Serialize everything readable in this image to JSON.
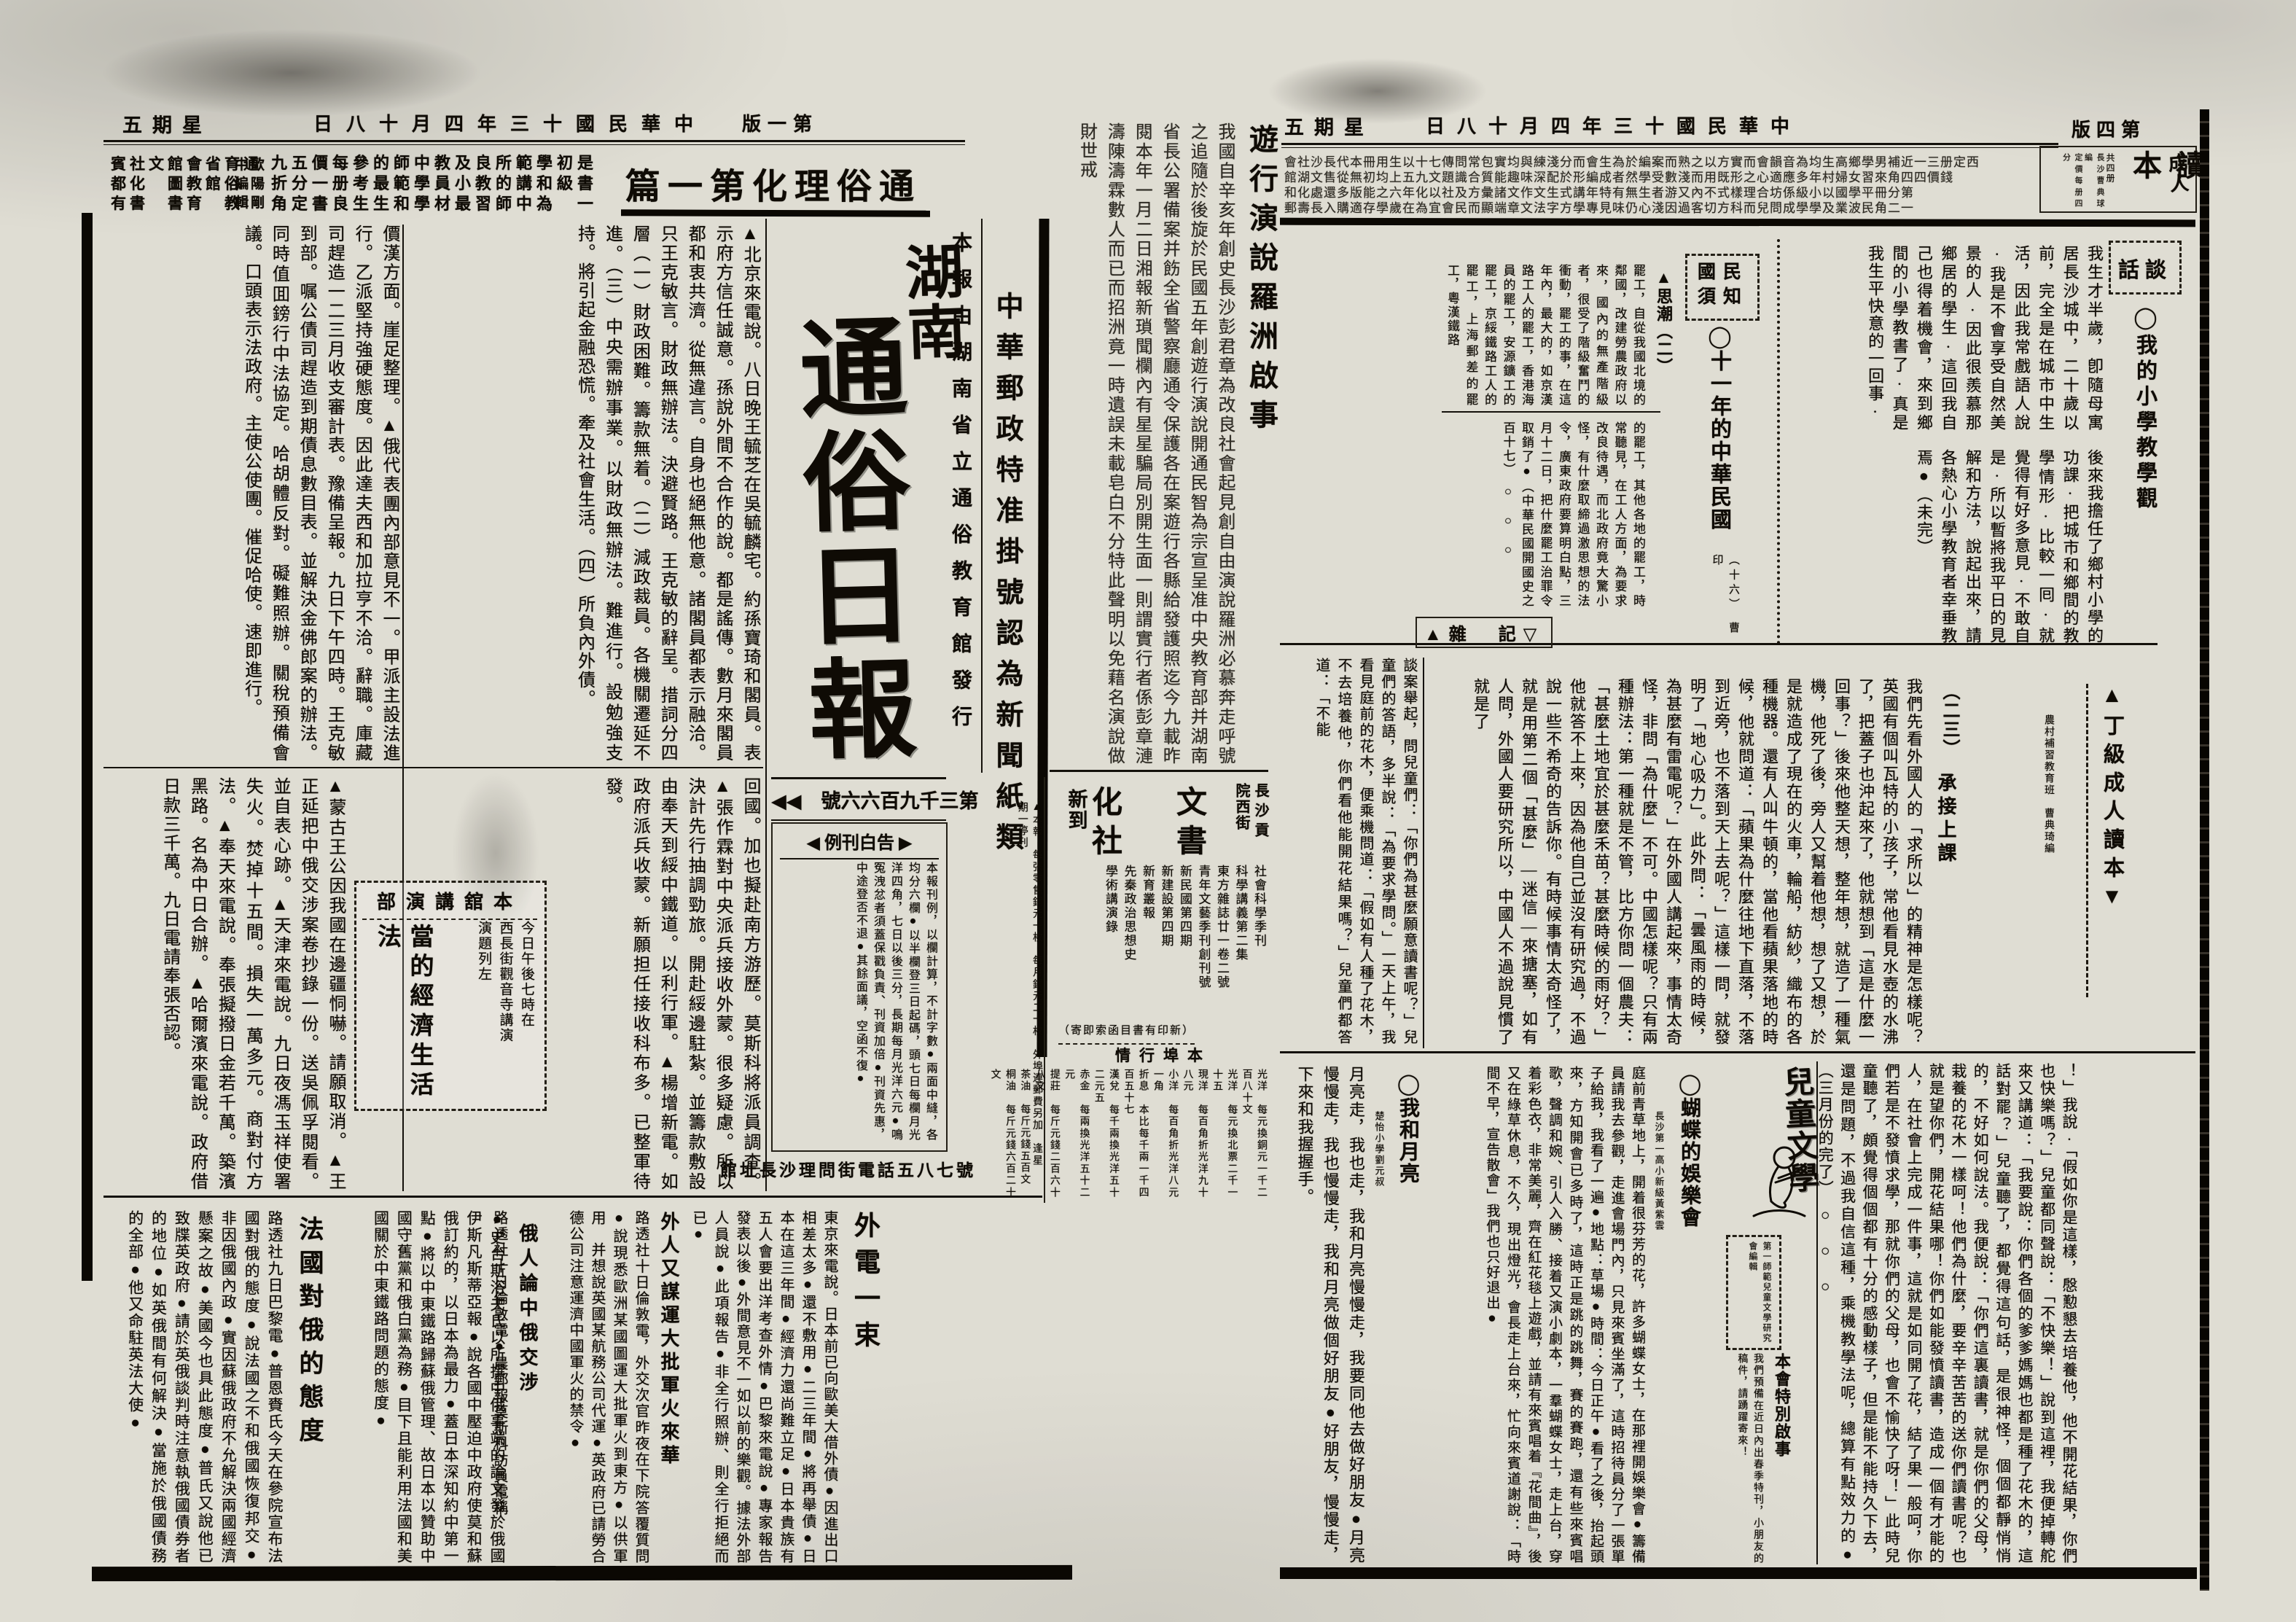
{
  "page1": {
    "header": {
      "weekday": "五期星",
      "date": "日八十月四年三十國民華中",
      "page": "版一第"
    },
    "top_ad": {
      "pub_rows": "賓社文館會省育通\n都化　圖教館俗\n有書　書育　教",
      "editor_rows": "中歐\n編陽\n輯剛",
      "rows": "九五價每參的師中教及良所範學初是\n折分一册考最範學員小教的講和級書\n角定書良生生和學材最習師中為　一",
      "headline": "篇一第化理俗通"
    },
    "announcement": {
      "title": "遊行演說羅洲啟事",
      "body": "我國自辛亥年創史長沙彭君章為改良社會起見創自由演說羅洲必慕奔走呼號之追隨於後旋於民國五年創遊行演說開通民智為宗宣呈准中央教育部并湖南省長公署備案并飭全省警察廳通令保護各在案遊行各縣給發護照迄今九載昨閱本年一月二日湘報新瑣聞欄內有星星騙局別開生面一則謂實行者係彭章漣濤陳濤霖數人而已而招洲竟一時遺誤未載皂白不分特此聲明以免藉名演說做財世戒"
    },
    "postal": "中華郵政特准掛號認為新聞紙類",
    "masthead": {
      "pub_line": "本報由湖南省立通俗教育館發行",
      "title_top": "湖南",
      "title_main": "通俗日報",
      "issue": "◀◀　號六六百九千三第"
    },
    "price_note": "▲本報　每張零售銅元一枚　每月銅元二十枚　外埠連郵費另加　逢星期一停刊",
    "adrates": {
      "title": "◀ 例刊白告 ▶",
      "body": "本報刊例，以欄計算，不計字數●兩面中縫，各均分六欄●以半欄登三日起碼，頭七日每欄月光洋四角，七日以後三分，長期每月光洋六元●鳴冤洩忿者須蓋保戳負責、刊資加倍●刊資先惠，中途登否不退●其餘面議，空函不復●"
    },
    "phone": "館址長沙理問街電話五八七號",
    "news": {
      "tr": "▲北京來電說。八日晚王毓芝在吳毓麟宅。約孫寶琦和閣員。表示府方信任誠意。孫說外間不合作的說。都是謠傳。數月來閣員都和衷共濟。從無違言。自身也絕無他意。諸閣員都表示融洽。只王克敏言。財政無辦法。決避賢路。王克敏的辭呈。措詞分四層（一）財政困難。籌款無着。（二）減政裁員。各機關遷延不進。（三）中央需辦事業。以財政無辦法。難進行。設勉強支持。將引起金融恐慌。牽及社會生活。（四）所負內外債。",
      "tl": "價漢方面。崖足整理。▲俄代表團內部意見不一。甲派主設法進行。乙派堅持強硬態度。因此達夫西和加拉亨不洽。辭職。庫藏司趕造一二三月收支審計表。豫備呈報。九日下午四時。王克敏到部。嘱公債司趕造到期債息數目表。並解決金佛郎案的辦法。同時值囬鎊行中法協定。哈胡體反對。礙難照辦。關稅預備會議。口頭表示法政府。主使公使團。催促哈使。速即進行。",
      "br": "回國。加也擬赴南方游歷。莫斯科將派員調查。▲張作霖對中央派兵接收外蒙。很多疑慮。所以決計先行抽調勁旅。開赴綏邊駐紮。並籌款敷設由奉天到綏中鐵道。以利行軍。▲楊增新電。如政府派兵收蒙。新願担任接收科布多。已整軍待發。",
      "bl": "▲蒙古王公因我國在邊疆恫嚇。請願取消。▲王正延把中俄交涉案卷抄錄一份。送吳佩孚閱看。並自表心跡。▲天津來電說。九日夜馮玉祥使署失火。焚掉十五間。損失一萬多元。商對付方法。▲奉天來電說。奉張擬撥日金若千萬。築濱黑路。名為中日合辦。▲哈爾濱來電說。政府借日款三千萬。九日電請奉張否認。"
    },
    "lecture_ad": {
      "title": "部演講舘本",
      "lines": "今日午後七時在\n西長街觀音寺講演\n演題列左",
      "big": "當的經濟生活法"
    },
    "bookstore": {
      "loc": "長沙貢院西街",
      "big_rows": "化　文\n社　書",
      "new_label": "新到",
      "books": "社會科學季刊\n科學講義第二集\n東方雜誌廿一卷二號\n青年文藝季刊創刊號\n新民國第四期\n新建設第四期\n新育叢報\n先秦政治思想史\n學術講演錄",
      "note": "（寄即索函目書有印新）",
      "market_title": "情行埠本",
      "market": "光洋　每元換銅元一千二百八十文\n光洋　每元換北票二千一十五\n現洋　每百角折光洋九十八元\n小洋　每百角折光洋八元一角\n折息　本比每千兩一千四百五十七\n漢兌　每千兩換光洋五十二元五\n赤金　每兩換光洋五十二元\n提莊　每斤元錢二百六十八文\n茶油　每斤元錢五百文\n桐油　每斤元錢六百二十文"
    },
    "bottom": {
      "france_title": "法國對俄的態度",
      "france_right": "●史台斯浴夫氏以所撰中俄事端的論文發於俄國伊斯凡斯蒂亞報●說各國中壓迫中政府使莫和蘇俄訂約的，以日本為最力●蓋日本深知約中第一點●將以中東鐵路歸蘇俄管理、故日本以贊助中國守舊黨和俄白黨為務●目下且能利用法國和美國關於中東鐵路問題的態度●",
      "france_left": "路透社九日巴黎電●普恩賚氏今天在參院宣布法國對俄的態度●說法國之不和俄國恢復邦交●非因俄國內政●實因蘇俄政府不允解決兩國經濟懸案之故●美國今也具此態度●普氏又說他已致牒英政府●請於英俄談判時注意執俄國債券者的地位●如英俄間有何解決●當施於俄國債務的全部●他又命駐英法大使●",
      "wire_title": "外電一束",
      "wire_body": "東京來電說。日本前已向歐美大借外債●因進出口相差太多●還不敷用●二三年間●將再舉債●日本在這三年間●經濟力還尚難立足●日本貴族有五人會要出洋考查外情●巴黎來電說●專家報告發表以後●外間意見不一如以前的樂觀。據法外部人員說●此項報告●非全行照辦、則全行拒絕而已●",
      "arms_title": "外人又謀運大批軍火來華",
      "arms_body": "路透社十日倫敦電，外交次官昨夜在下院答覆質問●說現悉歐洲某國圖運大批軍火到東方●以供軍用　并想說英國某航務公司代運●英政府已請勞合德公司注意運濟中國軍火的禁令●",
      "russia_title": "俄人論中俄交涉",
      "russia_body": "路透社十日倫敦電●晨郵報莫斯科訪員電稱"
    }
  },
  "page4": {
    "header": {
      "weekday": "五期星",
      "date": "日八十月四年三十國民華中",
      "page": "版四第"
    },
    "masthead": {
      "t1": "成人",
      "t2": "讀本",
      "n1": "共四册",
      "n2": "長沙曹典球編",
      "n3": "定價每册四分"
    },
    "ad_rows": "會社沙長代本冊用生以十七傳問常包實均與練淺分而會生為於編案而熟之以方實而會韻音為均生高鄉學男補近一三册定西\n館湖文售從無初均上五九文題識合質能趣味深配於形編成者然學受數淺而用既形之心適應多年村婦女習來角四四價錢\n和化處還多版能之六年化以社及方彙諸文作文生式講年特有無生者游又內不式樣理合坊係級小以國學平冊分第\n郵壽長入購適存學歲在為宜會民而顯端章文法字方學專見味仍心淺因過客切方科而兒問成學學及業波民角二一",
    "talk": {
      "box": "話談",
      "title": "◯我的小學教學觀",
      "upper": "我生才半歲，卽隨母寓居長沙城中，二十歲以前，完全是在城市中生活，因此我常戲語人說·我是不會享受自然美景的人·因此很羨慕那鄉居的學生·這回我自己也得着機會，來到鄉間的小學教書了·真是我生平快意的一回事·",
      "lower": "後來我擔任了鄉村小學的功課·把城市和鄉間的教學情形·比較一囘·就覺得有好多意見·不敢自是·所以暫將我平日的見解和方法，說起出來，請各熱心小學教育者幸垂教焉●（未完）"
    },
    "guomin": {
      "box": "國民\n須知",
      "title": "◯十一年的中華民國",
      "sub": "（十六）　曹印",
      "thought": "▲思潮（二）",
      "upper": "罷工，自從我國北境的鄰國，改建勞農政府以來，國內的無產階級者，很受了階級奮鬥的衝動，罷工的事，在這年內，最大的，如京漢路工人的罷工，香港海員的罷工，安源鑛工的罷工，京綏鐵路工人的罷工，上海郵差的罷工，粵漢鐵路",
      "lower": "的罷工，其他各地的罷工，時常聽見，在工人方面，為要求改良待遇，而北政府竟大驚小怪，有什麼取締過激思想的法令，廣東政府要算明白點，三月十二日，把什麼罷工治罪令取銷了●（中華民國開國史之百十七）　○　○　○"
    },
    "zaji": {
      "header": "▲雜　記▽",
      "body": "談案舉起，問兒童們：「你們為甚麼願意讀書呢？」兒童們的答語，多半說：「為要求學問。」一天上午，我看見庭前的花木，便乘機問道：「假如有人種了花木，不去培養他，你們看他能開花結果嗎？」兒童們都答道：「不能"
    },
    "lesson": {
      "grade": "▲丁級成人讀本▼",
      "byline": "農村補習教育班　曹典琦編",
      "no": "（二三）",
      "title": "承接上課",
      "body": "我們先看外國人的「求所以」的精神是怎樣呢？英國有個叫瓦特的小孩子，常他看見水壺的水沸了，把蓋子也沖起來了，他就想到「這是什麼一回事？」後來他整天想，整年想，就造了一種氣機，他死了後，旁人又幫着他想，想了又想，於是就造成了現在的火車，輪船，紡紗，織布的各種機器。還有人叫牛頓的，當他看蘋果落地的時候，他就問道：「蘋果為什麼往地下直落，不落到近旁，也不落到天上去呢？」這樣一問，就發明了「地心吸力」。此外問：「曇風雨的時候，為甚麼有雷電呢？」在外國人講起來，事情太奇怪，非問「為什麼」不可。中國怎樣呢？只有兩種辦法：第一種就是不管，比方你問一個農夫：「甚麼土地宜於甚麼禾苗？甚麼時候的雨好？」他就答不上來，因為他自己並沒有研究過，不過說一些不希奇的告訴你。有時候事情太奇怪了，就是用第二個「甚麼」—迷信—來搪塞，如有人問，外國人要研究所以，中國人不過說見慣了就是了"
    },
    "anecdote": "！」我說·「假如你是這樣，慇懃懇去培養他，他不開花結果，你們也快樂嗎？」兒童都同聲說：「不快樂！」說到這裡，我便掉轉舵來又講道：「我要說：你們各個的爹爹媽媽也都是種了花木的，這話對罷？」兒童聽了，都覺得這句話，是很神怪，個個都靜悄悄的，不好如何說法。我便說：「你們這裏讀書，就是你們的父母，栽養的花木一樣呵！他們為什麼，要辛辛苦苦的送你們讀書呢？也就是望你們，開花結果哪！你們如能發憤讀書，造成一個有才能的人，在社會上完成一件事，這就是如同開了花，結了果一般呵，你們若是不發憤求學，那就你們的父母，也會不愉快了呀！」此時兒童聽了，頗覺得個個都有十分的感動樣子，但是能不能持久下去，還是問題，不過我自信這種，乘機教學法呢，總算有點效力的●（三月份的完了）　○　○　○",
    "children": {
      "title": "兒童文學",
      "editor": "第一師範兒童文學研究會編輯",
      "notice_title": "本會特別啟事",
      "notice": "我們預備在近日內出春季特刊，小朋友的稿件，請踴躍寄來！"
    },
    "moon": {
      "title": "◯我和月亮",
      "byline": "楚怡小學劉元叔",
      "body": "月亮走，我也走，我和月亮慢慢走，我要同他去做好朋友●月亮慢慢走，我也慢慢走，我和月亮做個好朋友●好朋友，慢慢走，下來和我握握手。"
    },
    "butterfly": {
      "title": "◯蝴蝶的娛樂會",
      "byline": "長沙第一高小新級黃紫雲",
      "body": "庭前青草地上，開着很芬芳的花，許多蝴蝶女士，在那裡開娛樂會●籌備員請我去參觀，走進會場門內，只見來賓坐滿了，這時招待員分了一張單子給我，我看了一遍●地點：草場●時間：今日正午●看了之後，抬起頭來，方知開會已多時了，這時正是跳的跳舞，賽的賽跑，還有些來賓唱歌，聲調和婉、引人入勝、接着又演小劇本，一羣蝴蝶女士，走上台，穿着彩色衣，非常美麗，齊在紅花毯上遊戲，並請有來賓唱着『花間曲』，後又在綠草休息，不久，現出燈光，會長走上台來，忙向來賓道謝說：「時間不早，宣告散會」我們也只好退出●"
    }
  }
}
